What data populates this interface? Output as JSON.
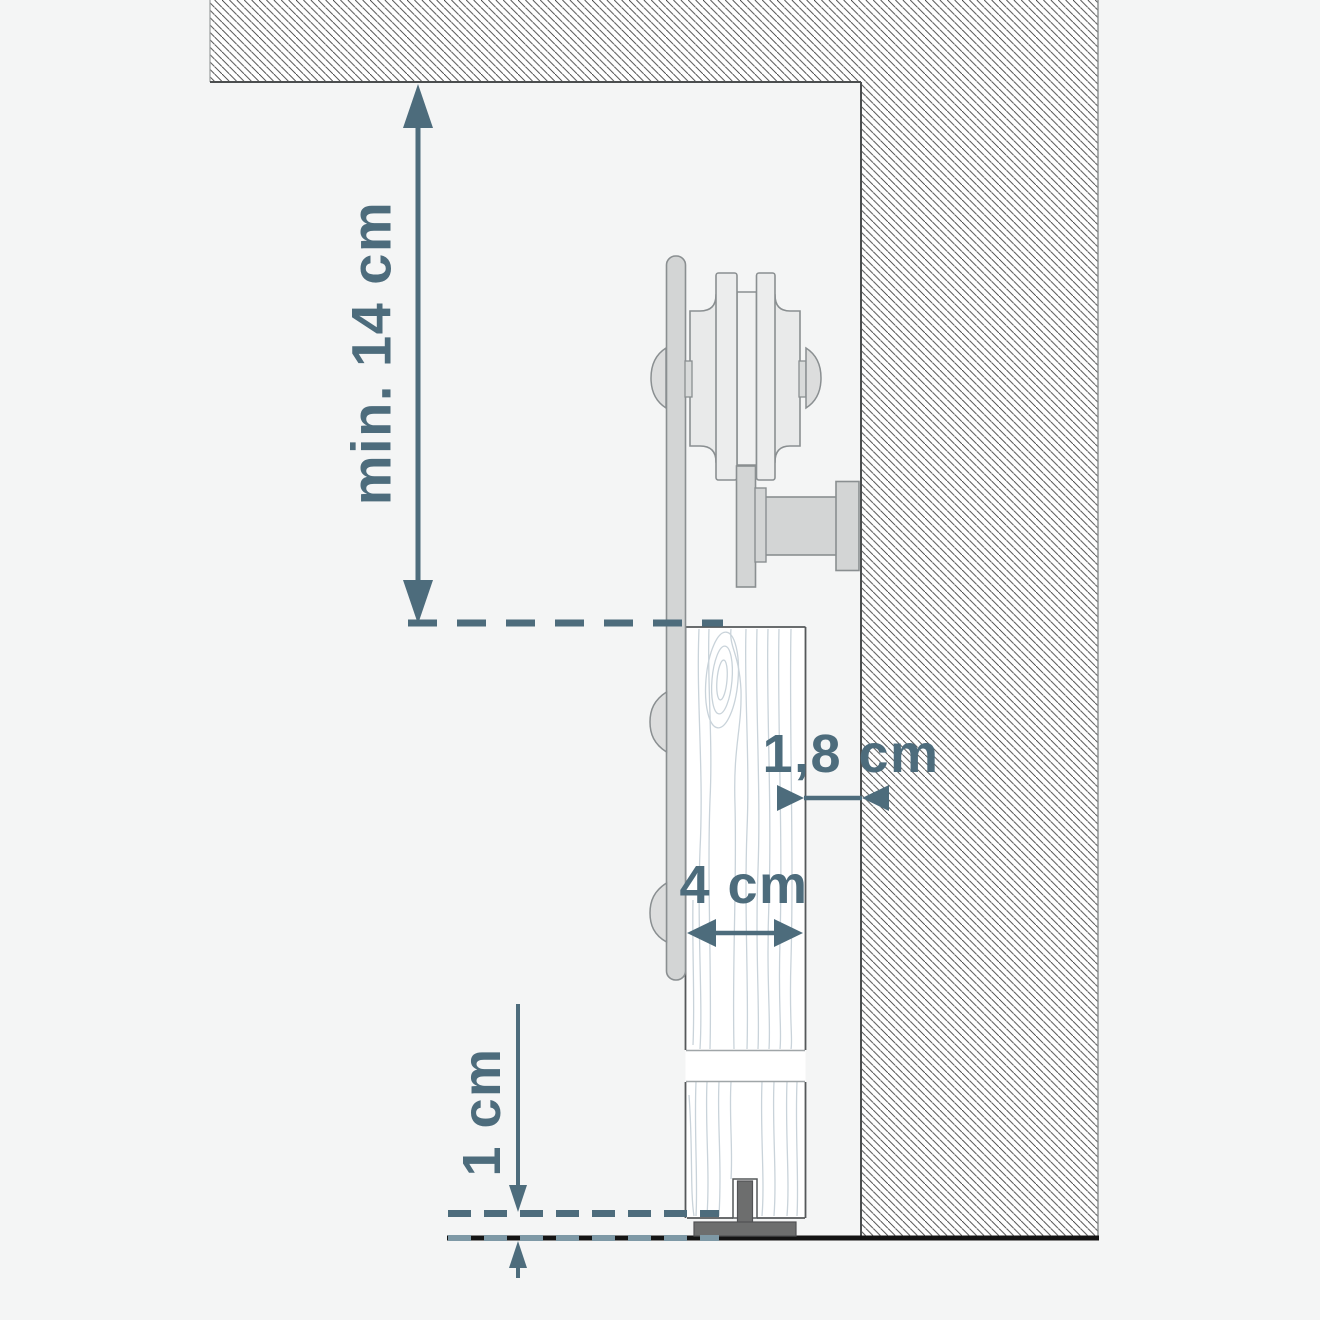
{
  "diagram": {
    "type": "sliding-door-installation-cross-section",
    "measurements": {
      "ceiling_clearance": {
        "label": "min. 14 cm"
      },
      "wall_gap": {
        "label": "1,8 cm"
      },
      "door_thickness": {
        "label": "4 cm"
      },
      "floor_clearance": {
        "label": "1 cm"
      }
    },
    "colors": {
      "dimension": "#4d6c7c",
      "dimension_light": "#7e99a6",
      "background": "#f4f5f5",
      "hatch_line": "#3e3e3e",
      "metal_fill": "#d3d5d5",
      "metal_light": "#eceded",
      "outline": "#8a8f91",
      "door_edge": "#55585a",
      "wood_grain": "#c9d3da",
      "floor": "#141414",
      "floor_guide": "#6d6e6e"
    }
  }
}
